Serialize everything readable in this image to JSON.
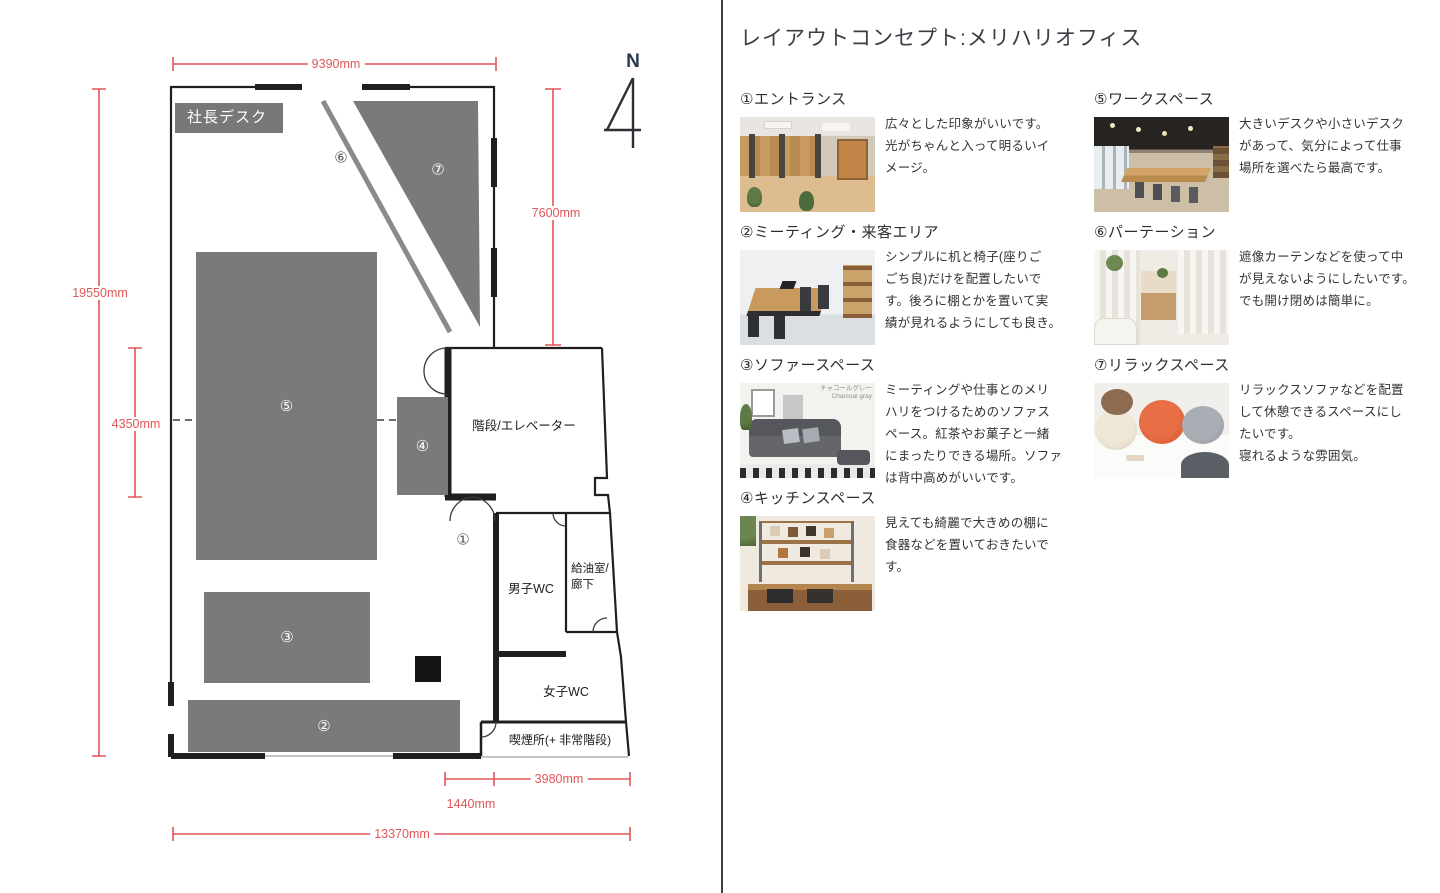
{
  "title": "レイアウトコンセプト:メリハリオフィス",
  "plan": {
    "president_desk": "社長デスク",
    "compass": "N",
    "dimensions": {
      "top": "9390mm",
      "left": "19550mm",
      "left_inner": "4350mm",
      "right": "7600mm",
      "bottom_offset": "1440mm",
      "bottom_small": "3980mm",
      "bottom_total": "13370mm"
    },
    "rooms": {
      "stairs_elevator": "階段/エレベーター",
      "mens_wc": "男子WC",
      "supply_corridor": "給油室/\n廊下",
      "womens_wc": "女子WC",
      "smoking": "喫煙所(+ 非常階段)"
    },
    "markers": {
      "m1": "①",
      "m2": "②",
      "m3": "③",
      "m4": "④",
      "m5": "⑤",
      "m6": "⑥",
      "m7": "⑦"
    }
  },
  "legend": {
    "items": [
      {
        "title": "①エントランス",
        "desc": "広々とした印象がいいです。\n光がちゃんと入って明るいイ\nメージ。"
      },
      {
        "title": "②ミーティング・来客エリア",
        "desc": "シンプルに机と椅子(座りご\nごち良)だけを配置したいで\nす。後ろに棚とかを置いて実\n績が見れるようにしても良き。"
      },
      {
        "title": "③ソファースペース",
        "desc": "ミーティングや仕事とのメリ\nハリをつけるためのソファス\nペース。紅茶やお菓子と一緒\nにまったりできる場所。ソファ\nは背中高めがいいです。",
        "photo_caption": "チャコールグレー\nCharcoal gray"
      },
      {
        "title": "④キッチンスペース",
        "desc": "見えても綺麗で大きめの棚に\n食器などを置いておきたいで\nす。"
      },
      {
        "title": "⑤ワークスペース",
        "desc": "大きいデスクや小さいデスク\nがあって、気分によって仕事\n場所を選べたら最高です。"
      },
      {
        "title": "⑥パーテーション",
        "desc": "遮像カーテンなどを使って中\nが見えないようにしたいです。\nでも開け閉めは簡単に。"
      },
      {
        "title": "⑦リラックスペース",
        "desc": "リラックスソファなどを配置\nして休憩できるスペースにし\nたいです。\n寝れるような雰囲気。"
      }
    ]
  },
  "colors": {
    "dimension_red": "#e05558",
    "area_gray": "#7a7a7a",
    "wall_black": "#1f1f1f"
  }
}
